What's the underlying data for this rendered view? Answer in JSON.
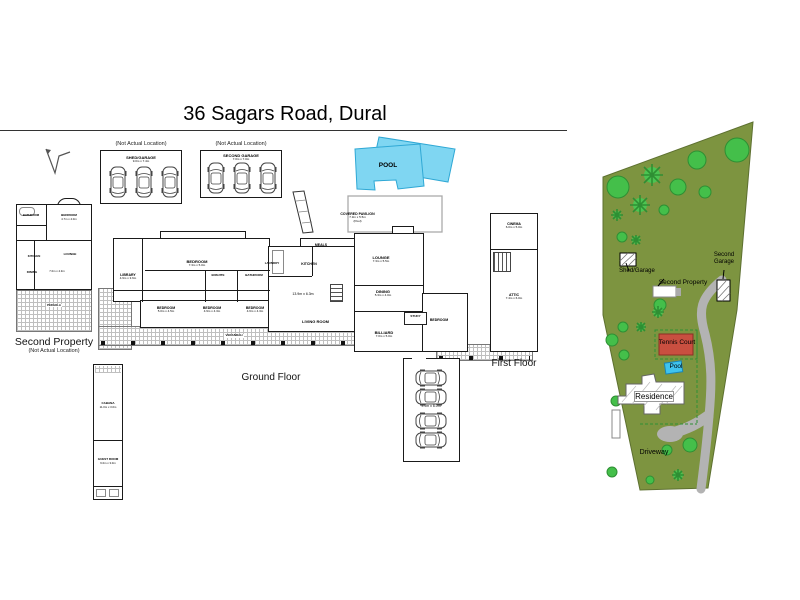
{
  "title": "36 Sagars Road, Dural",
  "shed_garage": {
    "note": "(Not Actual Location)",
    "name": "SHED/GARAGE",
    "dims": "9.0m x 7.4m"
  },
  "second_garage_plan": {
    "note": "(Not Actual Location)",
    "name": "SECOND GARAGE",
    "dims": "7.0m x 7.0m"
  },
  "pool_plan": {
    "label": "POOL",
    "fill": "#7fd6f2",
    "stroke": "#2fa8d5"
  },
  "second_property": {
    "label": "Second Property",
    "note": "(Not Actual Location)",
    "rooms": {
      "bathroom": "BATHROOM",
      "bedroom": {
        "name": "BEDROOM",
        "dims": "4.7m x 4.0m"
      },
      "kitchen": "KITCHEN",
      "lounge": "LOUNGE",
      "dining": "DINING",
      "area_dims": "7.0m x 4.3m",
      "pergola": "PERGOLA"
    }
  },
  "cabana": {
    "name": "CABANA",
    "dims": "11.0m x 3.0m",
    "guest": {
      "name": "GUEST ROOM",
      "dims": "6.0m x 3.0m"
    }
  },
  "ground_floor": {
    "label": "Ground Floor",
    "rooms": {
      "bedroom1": {
        "name": "BEDROOM",
        "dims": "7.3m x 5.0m"
      },
      "library": {
        "name": "LIBRARY",
        "dims": "4.9m x 3.6m"
      },
      "ensuite": "ENSUITE",
      "bathroom": "BATHROOM",
      "laundry": "LAUNDRY",
      "kitchen": "KITCHEN",
      "meals": "MEALS",
      "living": {
        "name": "LIVING ROOM",
        "dims": "13.9m x 6.3m"
      },
      "lounge": {
        "name": "LOUNGE",
        "dims": "7.3m x 5.5m"
      },
      "dining": {
        "name": "DINING",
        "dims": "5.3m x 4.0m"
      },
      "pavilion": {
        "name": "COVERED PAVILION",
        "dims": "7.3m x 5.5m",
        "note": "(Pool)"
      },
      "billiard": {
        "name": "BILLIARD",
        "dims": "7.0m x 5.0m"
      },
      "bedroom2": {
        "name": "BEDROOM",
        "dims": "5.0m x 4.5m"
      },
      "bedroom3": {
        "name": "BEDROOM",
        "dims": "4.9m x 4.3m"
      },
      "bedroom4": {
        "name": "BEDROOM",
        "dims": "4.6m x 4.3m"
      },
      "bedroom5": "BEDROOM",
      "study": "STUDY",
      "verandah": "VERANDAH",
      "garage_dims": "9.9m x 6.0m"
    }
  },
  "first_floor": {
    "label": "First Floor",
    "cinema": {
      "name": "CINEMA",
      "dims": "6.0m x 5.0m"
    },
    "attic": {
      "name": "ATTIC",
      "dims": "7.4m x 6.0m"
    }
  },
  "site_map": {
    "labels": {
      "shed_garage": "Shed/Garage",
      "second_property": "Second Property",
      "second_garage": "Second Garage",
      "tennis_court": "Tennis Court",
      "pool": "Pool",
      "residence": "Residence",
      "driveway": "Driveway"
    },
    "colors": {
      "grass": "#7d9440",
      "tree_fill": "#44bf4a",
      "tree_stroke": "#2e8f33",
      "tennis": "#c94f40",
      "pool": "#3fc4f0",
      "driveway": "#b3b3b3"
    }
  }
}
